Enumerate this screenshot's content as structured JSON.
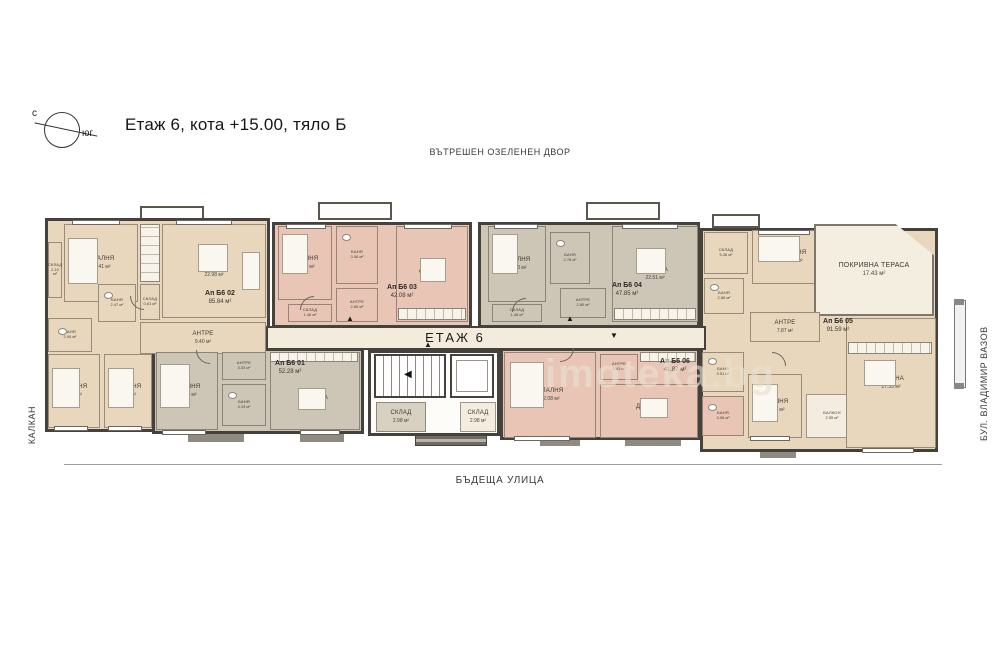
{
  "header": {
    "title": "Етаж 6, кота +15.00, тяло Б"
  },
  "compass": {
    "north": "с",
    "south": "юг"
  },
  "context": {
    "top": "ВЪТРЕШЕН ОЗЕЛЕНЕН ДВОР",
    "bottom": "БЪДЕЩА УЛИЦА",
    "left": "КАЛКАН",
    "right": "БУЛ. ВЛАДИМИР ВАЗОВ"
  },
  "plan": {
    "floor_label": "ЕТАЖ 6",
    "watermark": "imoteka.bg"
  },
  "colors": {
    "apartment_beige": "#e8d7bd",
    "apartment_salmon": "#e9c5b5",
    "apartment_taupe": "#cdc5b5",
    "walls": "#45423e",
    "terrace": "#f4eee1"
  },
  "apartments": [
    {
      "id": "b6-01",
      "label": "Ап Б6 01",
      "area": "52.28 м²",
      "rooms": [
        {
          "name": "СПАЛНЯ",
          "area": "12.44 м²"
        },
        {
          "name": "АНТРЕ",
          "area": "3.03 м²"
        },
        {
          "name": "БАНЯ",
          "area": "3.19 м²"
        },
        {
          "name": "ДНЕВНА",
          "area": "19.69 м²"
        }
      ]
    },
    {
      "id": "b6-02",
      "label": "Ап Б6 02",
      "area": "85.84 м²",
      "rooms": [
        {
          "name": "СКЛАД",
          "area": "2.10 м²"
        },
        {
          "name": "СПАЛНЯ",
          "area": "13.41 м²"
        },
        {
          "name": "ДНЕВНА",
          "area": "22.98 м²"
        },
        {
          "name": "СКЛАД",
          "area": "0.61 м²"
        },
        {
          "name": "БАНЯ",
          "area": "2.47 м²"
        },
        {
          "name": "БАНЯ",
          "area": "2.94 м²"
        },
        {
          "name": "АНТРЕ",
          "area": "9.40 м²"
        },
        {
          "name": "СПАЛНЯ",
          "area": "8.88 м²"
        },
        {
          "name": "СПАЛНЯ",
          "area": "8.98 м²"
        }
      ]
    },
    {
      "id": "b6-03",
      "label": "Ап Б6 03",
      "area": "42.08 м²",
      "rooms": [
        {
          "name": "СПАЛНЯ",
          "area": "10.15 м²"
        },
        {
          "name": "БАНЯ",
          "area": "3.08 м²"
        },
        {
          "name": "АНТРЕ",
          "area": "2.80 м²"
        },
        {
          "name": "ДНЕВНА",
          "area": "17.22 м²"
        },
        {
          "name": "СКЛАД",
          "area": "1.46 м²"
        }
      ]
    },
    {
      "id": "b6-04",
      "label": "Ап Б6 04",
      "area": "47.85 м²",
      "rooms": [
        {
          "name": "СПАЛНЯ",
          "area": "10.33 м²"
        },
        {
          "name": "БАНЯ",
          "area": "2.78 м²"
        },
        {
          "name": "АНТРЕ",
          "area": "2.80 м²"
        },
        {
          "name": "ДНЕВНА",
          "area": "22.51 м²"
        },
        {
          "name": "СКЛАД",
          "area": "1.46 м²"
        }
      ]
    },
    {
      "id": "b6-05",
      "label": "Ап Б6 05",
      "area": "91.59 м²",
      "rooms": [
        {
          "name": "СКЛАД",
          "area": "5.36 м²"
        },
        {
          "name": "СПАЛНЯ",
          "area": "13.16 м²"
        },
        {
          "name": "ПОКРИВНА ТЕРАСА",
          "area": "17.43 м²"
        },
        {
          "name": "БАНЯ",
          "area": "2.56 м²"
        },
        {
          "name": "АНТРЕ",
          "area": "7.87 м²"
        },
        {
          "name": "БАНЯ",
          "area": "3.51 м²"
        },
        {
          "name": "СПАЛНЯ",
          "area": "12.42 м²"
        },
        {
          "name": "БАЛКОН",
          "area": "2.55 м²"
        },
        {
          "name": "ДНЕВНА",
          "area": "27.35 м²"
        }
      ]
    },
    {
      "id": "b6-06",
      "label": "Ап Б6 06",
      "area": "41.87 м²",
      "rooms": [
        {
          "name": "СПАЛНЯ",
          "area": "12.08 м²"
        },
        {
          "name": "АНТРЕ",
          "area": "2.41 м²"
        },
        {
          "name": "ДНЕВНА",
          "area": "17.22 м²"
        },
        {
          "name": "БАНЯ",
          "area": "3.06 м²"
        }
      ]
    }
  ],
  "core": {
    "rooms": [
      {
        "name": "СКЛАД",
        "area": "2.98 м²"
      },
      {
        "name": "СКЛАД",
        "area": "2.98 м²"
      }
    ]
  }
}
